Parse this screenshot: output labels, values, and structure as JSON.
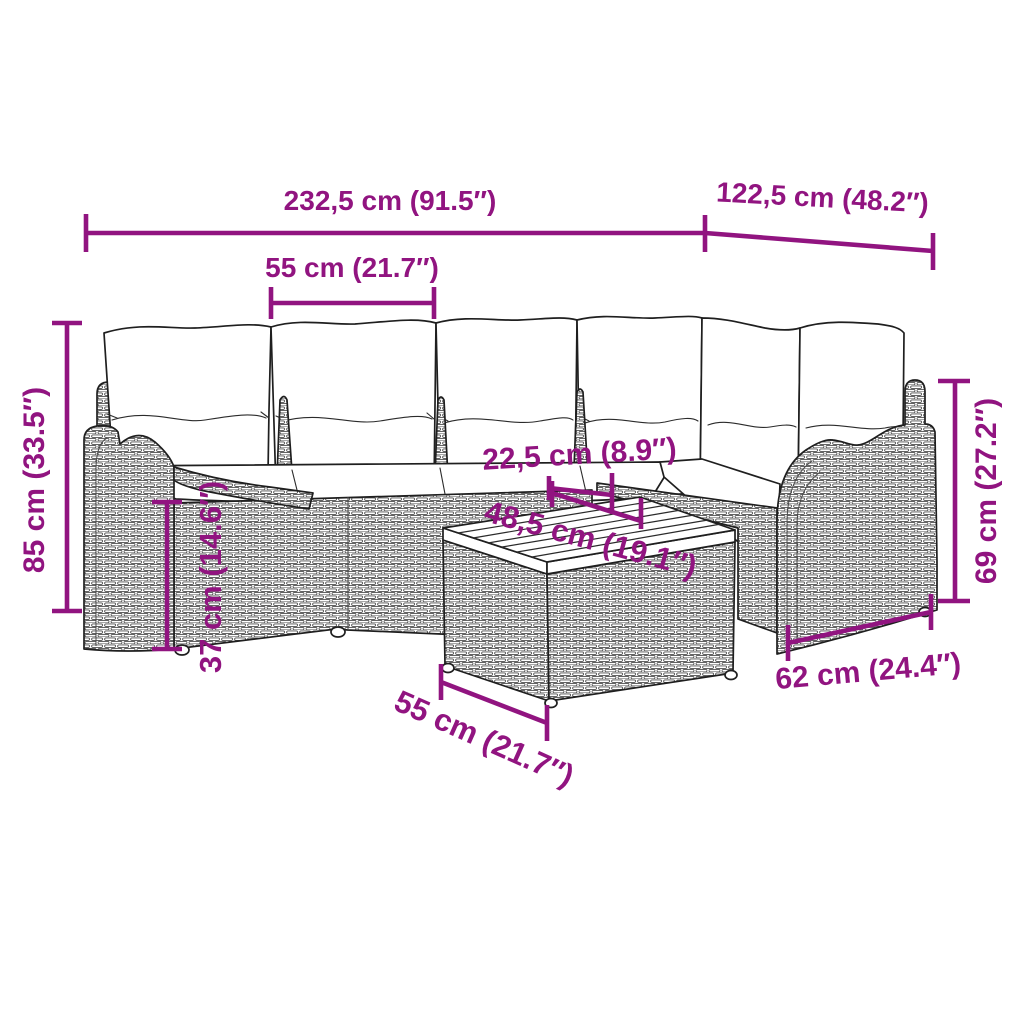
{
  "colors": {
    "annotation": "#911480",
    "line_art": "#1f1f1f",
    "wicker_stroke": "#4d4d4d",
    "background": "#ffffff"
  },
  "annotations": {
    "overall_width": "232,5 cm (91.5″)",
    "right_section_depth": "122,5 cm (48.2″)",
    "seat_width": "55 cm (21.7″)",
    "back_height": "85 cm (33.5″)",
    "seat_height": "37 cm (14.6″)",
    "tabletop_inner_width": "22,5 cm (8.9″)",
    "tabletop_width": "48,5 cm (19.1″)",
    "armrest_height": "69 cm (27.2″)",
    "armrest_section_width": "62 cm (24.4″)",
    "table_length": "55 cm (21.7″)"
  }
}
